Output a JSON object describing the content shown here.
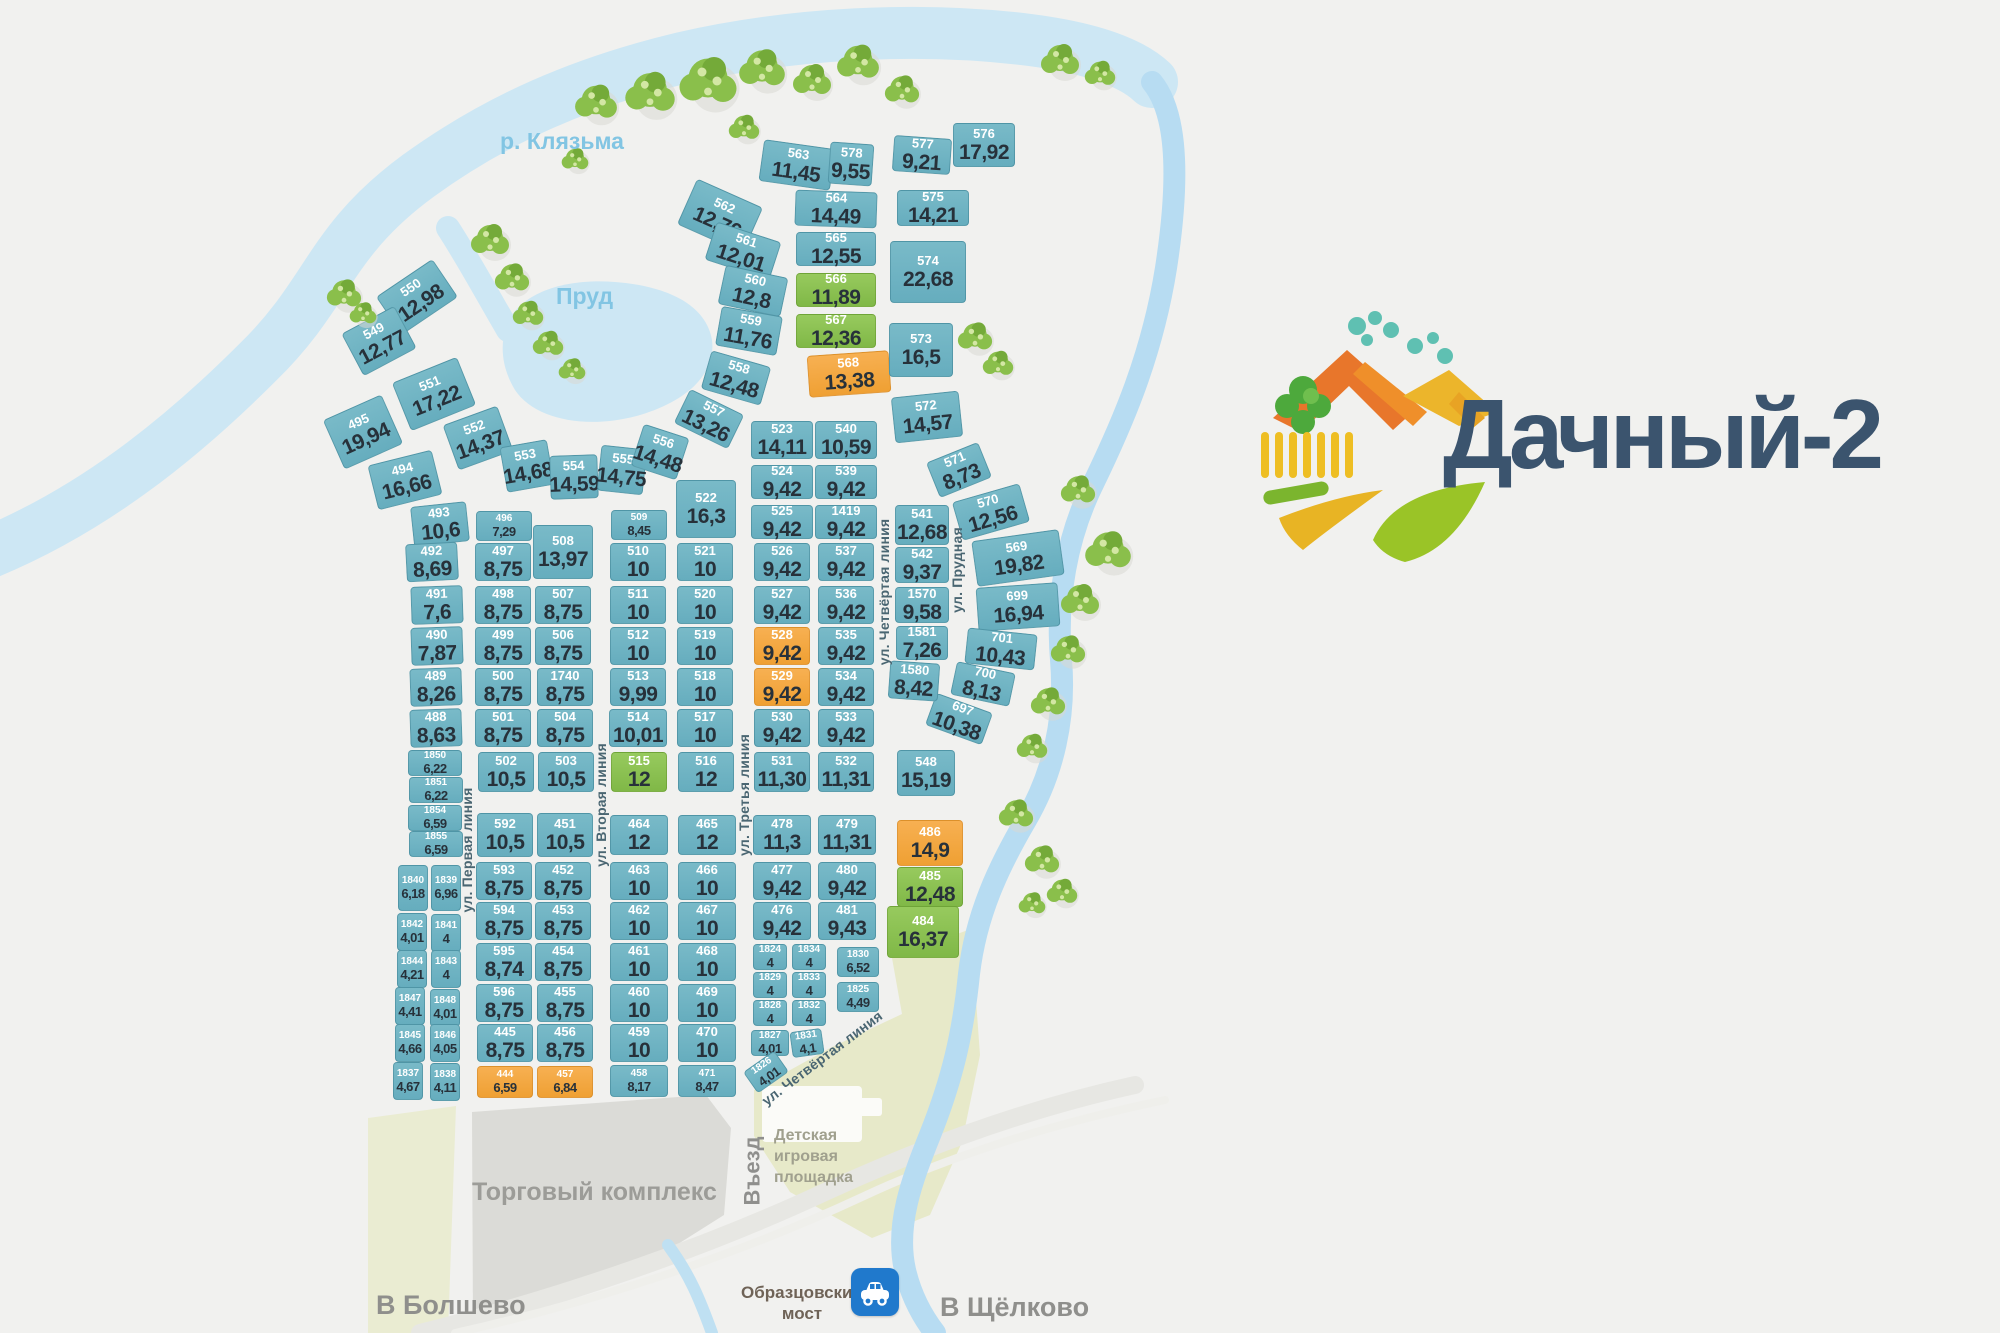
{
  "logo": {
    "text": "Дачный-2"
  },
  "labels": {
    "river": "р. Клязьма",
    "pond": "Пруд",
    "mall": "Торговый комплекс",
    "entrance": "Въезд",
    "playground": "Детская игровая площадка",
    "to_bolshevo": "В Болшево",
    "bridge": "Образцовский мост",
    "to_schelkovo": "В Щёлково"
  },
  "colors": {
    "plot_teal": "#6fb3c2",
    "plot_green": "#8cc152",
    "plot_orange": "#f5a840",
    "water": "#cde7f4",
    "logo_text": "#3b546e"
  },
  "streets": [
    {
      "name": "ул. Первая линия",
      "x": 467,
      "y": 850,
      "rot": -90
    },
    {
      "name": "ул. Вторая линия",
      "x": 601,
      "y": 805,
      "rot": -90
    },
    {
      "name": "ул. Третья линия",
      "x": 744,
      "y": 795,
      "rot": -90
    },
    {
      "name": "ул. Четвёртая линия",
      "x": 884,
      "y": 592,
      "rot": -90
    },
    {
      "name": "ул. Прудная",
      "x": 957,
      "y": 570,
      "rot": -90
    },
    {
      "name": "ул. Четвёртая линия",
      "x": 822,
      "y": 1058,
      "rot": -37
    }
  ],
  "plots": [
    [
      "563",
      "11,45",
      797,
      165,
      72,
      42,
      "t",
      8
    ],
    [
      "578",
      "9,55",
      851,
      164,
      44,
      42,
      "t",
      4
    ],
    [
      "577",
      "9,21",
      922,
      155,
      58,
      36,
      "t",
      4
    ],
    [
      "576",
      "17,92",
      984,
      145,
      62,
      44,
      "t",
      0
    ],
    [
      "564",
      "14,49",
      836,
      209,
      82,
      36,
      "t",
      2
    ],
    [
      "575",
      "14,21",
      933,
      208,
      72,
      36,
      "t",
      0
    ],
    [
      "562",
      "12,76",
      720,
      216,
      72,
      50,
      "t",
      24
    ],
    [
      "561",
      "12,01",
      743,
      251,
      68,
      40,
      "t",
      18
    ],
    [
      "565",
      "12,55",
      836,
      249,
      80,
      34,
      "t",
      0
    ],
    [
      "574",
      "22,68",
      928,
      272,
      76,
      62,
      "t",
      0
    ],
    [
      "560",
      "12,8",
      753,
      291,
      64,
      40,
      "t",
      12
    ],
    [
      "566",
      "11,89",
      836,
      290,
      80,
      34,
      "g",
      0
    ],
    [
      "559",
      "11,76",
      749,
      331,
      62,
      40,
      "t",
      10
    ],
    [
      "567",
      "12,36",
      836,
      331,
      80,
      34,
      "g",
      0
    ],
    [
      "568",
      "13,38",
      849,
      374,
      82,
      42,
      "o",
      -4
    ],
    [
      "573",
      "16,5",
      921,
      350,
      64,
      54,
      "t",
      0
    ],
    [
      "558",
      "12,48",
      736,
      378,
      62,
      40,
      "t",
      16
    ],
    [
      "557",
      "13,26",
      709,
      419,
      60,
      38,
      "t",
      26
    ],
    [
      "572",
      "14,57",
      927,
      417,
      68,
      46,
      "t",
      -6
    ],
    [
      "550",
      "12,98",
      417,
      297,
      68,
      46,
      "t",
      -34
    ],
    [
      "549",
      "12,77",
      379,
      341,
      60,
      48,
      "t",
      -28
    ],
    [
      "551",
      "17,22",
      434,
      394,
      70,
      52,
      "t",
      -22
    ],
    [
      "495",
      "19,94",
      363,
      432,
      64,
      54,
      "t",
      -24
    ],
    [
      "552",
      "14,37",
      478,
      438,
      58,
      48,
      "t",
      -20
    ],
    [
      "494",
      "16,66",
      405,
      480,
      66,
      46,
      "t",
      -14
    ],
    [
      "553",
      "14,68",
      527,
      466,
      48,
      46,
      "t",
      -10
    ],
    [
      "554",
      "14,59",
      574,
      477,
      48,
      44,
      "t",
      -2
    ],
    [
      "555",
      "14,75",
      622,
      470,
      46,
      46,
      "t",
      6
    ],
    [
      "556",
      "14,48",
      660,
      452,
      48,
      44,
      "t",
      18
    ],
    [
      "523",
      "14,11",
      782,
      440,
      62,
      38,
      "t",
      0
    ],
    [
      "540",
      "10,59",
      846,
      440,
      62,
      38,
      "t",
      0
    ],
    [
      "571",
      "8,73",
      959,
      470,
      56,
      38,
      "t",
      -22
    ],
    [
      "570",
      "12,56",
      991,
      512,
      70,
      40,
      "t",
      -16
    ],
    [
      "569",
      "19,82",
      1018,
      558,
      88,
      46,
      "t",
      -8
    ],
    [
      "699",
      "16,94",
      1018,
      607,
      82,
      44,
      "t",
      -4
    ],
    [
      "701",
      "10,43",
      1001,
      649,
      70,
      36,
      "t",
      6
    ],
    [
      "700",
      "8,13",
      983,
      684,
      60,
      34,
      "t",
      12
    ],
    [
      "697",
      "10,38",
      959,
      719,
      60,
      34,
      "t",
      20
    ],
    [
      "524",
      "9,42",
      782,
      482,
      62,
      34,
      "t",
      0
    ],
    [
      "539",
      "9,42",
      846,
      482,
      62,
      34,
      "t",
      0
    ],
    [
      "522",
      "16,3",
      706,
      509,
      60,
      58,
      "t",
      0
    ],
    [
      "525",
      "9,42",
      782,
      522,
      62,
      34,
      "t",
      0
    ],
    [
      "1419",
      "9,42",
      846,
      522,
      62,
      34,
      "t",
      0
    ],
    [
      "541",
      "12,68",
      922,
      525,
      54,
      40,
      "t",
      0
    ],
    [
      "493",
      "10,6",
      440,
      524,
      56,
      40,
      "t",
      -6
    ],
    [
      "496",
      "7,29",
      504,
      526,
      56,
      30,
      "t",
      0
    ],
    [
      "509",
      "8,45",
      639,
      525,
      56,
      30,
      "t",
      0
    ],
    [
      "508",
      "13,97",
      563,
      552,
      60,
      54,
      "t",
      0
    ],
    [
      "492",
      "8,69",
      432,
      562,
      52,
      38,
      "t",
      -3
    ],
    [
      "497",
      "8,75",
      503,
      562,
      56,
      38,
      "t",
      0
    ],
    [
      "510",
      "10",
      638,
      562,
      56,
      38,
      "t",
      0
    ],
    [
      "521",
      "10",
      705,
      562,
      56,
      38,
      "t",
      0
    ],
    [
      "526",
      "9,42",
      782,
      562,
      56,
      38,
      "t",
      0
    ],
    [
      "537",
      "9,42",
      846,
      562,
      56,
      38,
      "t",
      0
    ],
    [
      "542",
      "9,37",
      922,
      565,
      54,
      36,
      "t",
      0
    ],
    [
      "491",
      "7,6",
      437,
      605,
      52,
      38,
      "t",
      -2
    ],
    [
      "498",
      "8,75",
      503,
      605,
      56,
      38,
      "t",
      0
    ],
    [
      "507",
      "8,75",
      563,
      605,
      56,
      38,
      "t",
      0
    ],
    [
      "511",
      "10",
      638,
      605,
      56,
      38,
      "t",
      0
    ],
    [
      "520",
      "10",
      705,
      605,
      56,
      38,
      "t",
      0
    ],
    [
      "527",
      "9,42",
      782,
      605,
      56,
      38,
      "t",
      0
    ],
    [
      "536",
      "9,42",
      846,
      605,
      56,
      38,
      "t",
      0
    ],
    [
      "1570",
      "9,58",
      922,
      605,
      54,
      36,
      "t",
      0
    ],
    [
      "490",
      "7,87",
      437,
      646,
      52,
      38,
      "t",
      -2
    ],
    [
      "499",
      "8,75",
      503,
      646,
      56,
      38,
      "t",
      0
    ],
    [
      "506",
      "8,75",
      563,
      646,
      56,
      38,
      "t",
      0
    ],
    [
      "512",
      "10",
      638,
      646,
      56,
      38,
      "t",
      0
    ],
    [
      "519",
      "10",
      705,
      646,
      56,
      38,
      "t",
      0
    ],
    [
      "528",
      "9,42",
      782,
      646,
      56,
      38,
      "o",
      0
    ],
    [
      "535",
      "9,42",
      846,
      646,
      56,
      38,
      "t",
      0
    ],
    [
      "1581",
      "7,26",
      922,
      643,
      52,
      34,
      "t",
      0
    ],
    [
      "489",
      "8,26",
      436,
      687,
      52,
      38,
      "t",
      -2
    ],
    [
      "500",
      "8,75",
      503,
      687,
      56,
      38,
      "t",
      0
    ],
    [
      "1740",
      "8,75",
      565,
      687,
      56,
      38,
      "t",
      0
    ],
    [
      "513",
      "9,99",
      638,
      687,
      56,
      38,
      "t",
      0
    ],
    [
      "518",
      "10",
      705,
      687,
      56,
      38,
      "t",
      0
    ],
    [
      "529",
      "9,42",
      782,
      687,
      56,
      38,
      "o",
      0
    ],
    [
      "534",
      "9,42",
      846,
      687,
      56,
      38,
      "t",
      0
    ],
    [
      "1580",
      "8,42",
      914,
      681,
      50,
      38,
      "t",
      4
    ],
    [
      "488",
      "8,63",
      436,
      728,
      52,
      38,
      "t",
      -2
    ],
    [
      "501",
      "8,75",
      503,
      728,
      56,
      38,
      "t",
      0
    ],
    [
      "504",
      "8,75",
      565,
      728,
      56,
      38,
      "t",
      0
    ],
    [
      "514",
      "10,01",
      638,
      728,
      58,
      38,
      "t",
      0
    ],
    [
      "517",
      "10",
      705,
      728,
      56,
      38,
      "t",
      0
    ],
    [
      "530",
      "9,42",
      782,
      728,
      56,
      38,
      "t",
      0
    ],
    [
      "533",
      "9,42",
      846,
      728,
      56,
      38,
      "t",
      0
    ],
    [
      "1850",
      "6,22",
      435,
      763,
      54,
      26,
      "t",
      0
    ],
    [
      "502",
      "10,5",
      506,
      772,
      56,
      40,
      "t",
      0
    ],
    [
      "503",
      "10,5",
      566,
      772,
      56,
      40,
      "t",
      0
    ],
    [
      "515",
      "12",
      639,
      772,
      56,
      40,
      "g",
      0
    ],
    [
      "516",
      "12",
      706,
      772,
      56,
      40,
      "t",
      0
    ],
    [
      "531",
      "11,30",
      782,
      772,
      56,
      40,
      "t",
      0
    ],
    [
      "532",
      "11,31",
      846,
      772,
      56,
      40,
      "t",
      0
    ],
    [
      "548",
      "15,19",
      926,
      773,
      58,
      46,
      "t",
      0
    ],
    [
      "1851",
      "6,22",
      436,
      790,
      54,
      26,
      "t",
      0
    ],
    [
      "1854",
      "6,59",
      435,
      818,
      54,
      26,
      "t",
      0
    ],
    [
      "1855",
      "6,59",
      436,
      844,
      54,
      26,
      "t",
      0
    ],
    [
      "592",
      "10,5",
      505,
      835,
      56,
      44,
      "t",
      0
    ],
    [
      "451",
      "10,5",
      565,
      835,
      56,
      44,
      "t",
      0
    ],
    [
      "464",
      "12",
      639,
      835,
      58,
      40,
      "t",
      0
    ],
    [
      "465",
      "12",
      707,
      835,
      58,
      40,
      "t",
      0
    ],
    [
      "478",
      "11,3",
      782,
      835,
      58,
      40,
      "t",
      0
    ],
    [
      "479",
      "11,31",
      847,
      835,
      58,
      40,
      "t",
      0
    ],
    [
      "486",
      "14,9",
      930,
      843,
      66,
      46,
      "o",
      0
    ],
    [
      "1840",
      "6,18",
      413,
      888,
      30,
      46,
      "t",
      0
    ],
    [
      "1839",
      "6,96",
      446,
      888,
      30,
      46,
      "t",
      0
    ],
    [
      "593",
      "8,75",
      504,
      881,
      56,
      38,
      "t",
      0
    ],
    [
      "452",
      "8,75",
      563,
      881,
      56,
      38,
      "t",
      0
    ],
    [
      "463",
      "10",
      639,
      881,
      58,
      38,
      "t",
      0
    ],
    [
      "466",
      "10",
      707,
      881,
      58,
      38,
      "t",
      0
    ],
    [
      "477",
      "9,42",
      782,
      881,
      58,
      38,
      "t",
      0
    ],
    [
      "480",
      "9,42",
      847,
      881,
      58,
      38,
      "t",
      0
    ],
    [
      "485",
      "12,48",
      930,
      887,
      66,
      40,
      "g",
      0
    ],
    [
      "1842",
      "4,01",
      412,
      932,
      30,
      38,
      "t",
      0
    ],
    [
      "1841",
      "4",
      446,
      933,
      30,
      38,
      "t",
      0
    ],
    [
      "594",
      "8,75",
      504,
      921,
      56,
      38,
      "t",
      0
    ],
    [
      "453",
      "8,75",
      563,
      921,
      56,
      38,
      "t",
      0
    ],
    [
      "462",
      "10",
      639,
      921,
      58,
      38,
      "t",
      0
    ],
    [
      "467",
      "10",
      707,
      921,
      58,
      38,
      "t",
      0
    ],
    [
      "476",
      "9,42",
      782,
      921,
      58,
      38,
      "t",
      0
    ],
    [
      "481",
      "9,43",
      847,
      921,
      58,
      38,
      "t",
      0
    ],
    [
      "484",
      "16,37",
      923,
      932,
      72,
      52,
      "g",
      0
    ],
    [
      "1844",
      "4,21",
      412,
      969,
      30,
      38,
      "t",
      0
    ],
    [
      "1843",
      "4",
      446,
      969,
      30,
      38,
      "t",
      0
    ],
    [
      "595",
      "8,74",
      504,
      962,
      56,
      38,
      "t",
      0
    ],
    [
      "454",
      "8,75",
      563,
      962,
      56,
      38,
      "t",
      0
    ],
    [
      "461",
      "10",
      639,
      962,
      58,
      38,
      "t",
      0
    ],
    [
      "468",
      "10",
      707,
      962,
      58,
      38,
      "t",
      0
    ],
    [
      "1824",
      "4",
      770,
      957,
      34,
      26,
      "t",
      0
    ],
    [
      "1834",
      "4",
      809,
      957,
      34,
      26,
      "t",
      0
    ],
    [
      "1830",
      "6,52",
      858,
      962,
      42,
      30,
      "t",
      0
    ],
    [
      "1847",
      "4,41",
      410,
      1006,
      30,
      38,
      "t",
      0
    ],
    [
      "1848",
      "4,01",
      445,
      1008,
      30,
      38,
      "t",
      0
    ],
    [
      "596",
      "8,75",
      504,
      1003,
      56,
      38,
      "t",
      0
    ],
    [
      "455",
      "8,75",
      565,
      1003,
      56,
      38,
      "t",
      0
    ],
    [
      "460",
      "10",
      639,
      1003,
      58,
      38,
      "t",
      0
    ],
    [
      "469",
      "10",
      707,
      1003,
      58,
      38,
      "t",
      0
    ],
    [
      "1829",
      "4",
      770,
      985,
      34,
      26,
      "t",
      0
    ],
    [
      "1833",
      "4",
      809,
      985,
      34,
      26,
      "t",
      0
    ],
    [
      "1825",
      "4,49",
      858,
      997,
      42,
      30,
      "t",
      0
    ],
    [
      "1845",
      "4,66",
      410,
      1043,
      30,
      38,
      "t",
      0
    ],
    [
      "1846",
      "4,05",
      445,
      1043,
      30,
      38,
      "t",
      0
    ],
    [
      "445",
      "8,75",
      505,
      1043,
      56,
      38,
      "t",
      0
    ],
    [
      "456",
      "8,75",
      565,
      1043,
      56,
      38,
      "t",
      0
    ],
    [
      "459",
      "10",
      639,
      1043,
      58,
      38,
      "t",
      0
    ],
    [
      "470",
      "10",
      707,
      1043,
      58,
      38,
      "t",
      0
    ],
    [
      "1828",
      "4",
      770,
      1013,
      34,
      26,
      "t",
      0
    ],
    [
      "1832",
      "4",
      809,
      1013,
      34,
      26,
      "t",
      0
    ],
    [
      "1837",
      "4,67",
      408,
      1081,
      30,
      38,
      "t",
      0
    ],
    [
      "1838",
      "4,11",
      445,
      1082,
      30,
      38,
      "t",
      0
    ],
    [
      "444",
      "6,59",
      505,
      1082,
      56,
      32,
      "o",
      0
    ],
    [
      "457",
      "6,84",
      565,
      1082,
      56,
      32,
      "o",
      0
    ],
    [
      "458",
      "8,17",
      639,
      1081,
      58,
      32,
      "t",
      0
    ],
    [
      "471",
      "8,47",
      707,
      1081,
      58,
      32,
      "t",
      0
    ],
    [
      "1827",
      "4,01",
      770,
      1043,
      38,
      26,
      "t",
      0
    ],
    [
      "1831",
      "4,1",
      807,
      1043,
      32,
      26,
      "t",
      -8
    ],
    [
      "1826",
      "4,01",
      766,
      1072,
      38,
      26,
      "t",
      -35
    ]
  ]
}
